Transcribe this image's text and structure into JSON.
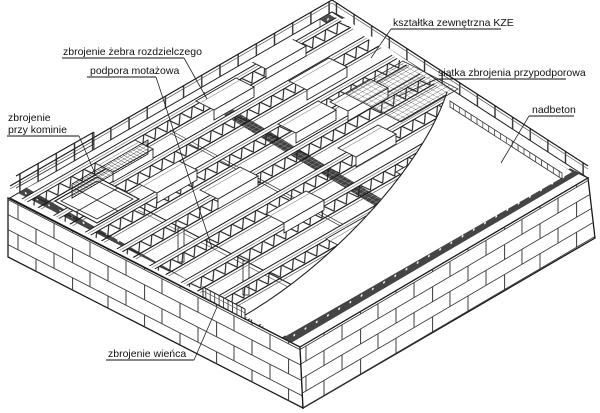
{
  "figure": {
    "kind": "isometric construction diagram",
    "subject": "ribbed floor slab assembly on masonry walls"
  },
  "style": {
    "background": "#ffffff",
    "line_color": "#1a1a1a",
    "label_color": "#111111",
    "dark_fill": "#454545",
    "font_size": 10.5
  },
  "labels": [
    {
      "id": "zebro-rozdzielcze",
      "text": "zbrojenie żebra rozdzielczego",
      "x": 63,
      "y": 55,
      "underline": [
        62,
        58,
        184,
        58
      ],
      "leader": [
        184,
        58,
        207,
        99
      ]
    },
    {
      "id": "podpora-montazowa",
      "text": "podpora motażowa",
      "x": 90,
      "y": 74,
      "underline": [
        87,
        77,
        156,
        77
      ],
      "leader": [
        156,
        77,
        212,
        248
      ]
    },
    {
      "id": "zbrojenie-przy-kominie",
      "lines": [
        "zbrojenie",
        "przy kominie"
      ],
      "x": 8,
      "y": 121,
      "line_height": 12,
      "underline": [
        7,
        136,
        79,
        136
      ],
      "leader": [
        79,
        136,
        96,
        176
      ]
    },
    {
      "id": "ksztaltka-kze",
      "text": "kształtka zewnętrzna KZE",
      "x": 393,
      "y": 26,
      "underline": [
        391,
        29,
        501,
        29
      ],
      "leader": [
        391,
        29,
        371,
        58
      ]
    },
    {
      "id": "siatka-przypodporowa",
      "text": "siatka zbrojenia przypodporowa",
      "x": 438,
      "y": 76,
      "underline": [
        437,
        79,
        566,
        79
      ],
      "leader": [
        437,
        79,
        399,
        96
      ]
    },
    {
      "id": "nadbeton",
      "text": "nadbeton",
      "x": 532,
      "y": 113,
      "underline": [
        529,
        116,
        574,
        116
      ],
      "leader": [
        529,
        116,
        501,
        163
      ]
    },
    {
      "id": "zbrojenie-wienca",
      "text": "zbrojenie wieńca",
      "x": 108,
      "y": 357,
      "underline": [
        106,
        360,
        194,
        360
      ],
      "leader": [
        194,
        360,
        217,
        307
      ]
    }
  ]
}
